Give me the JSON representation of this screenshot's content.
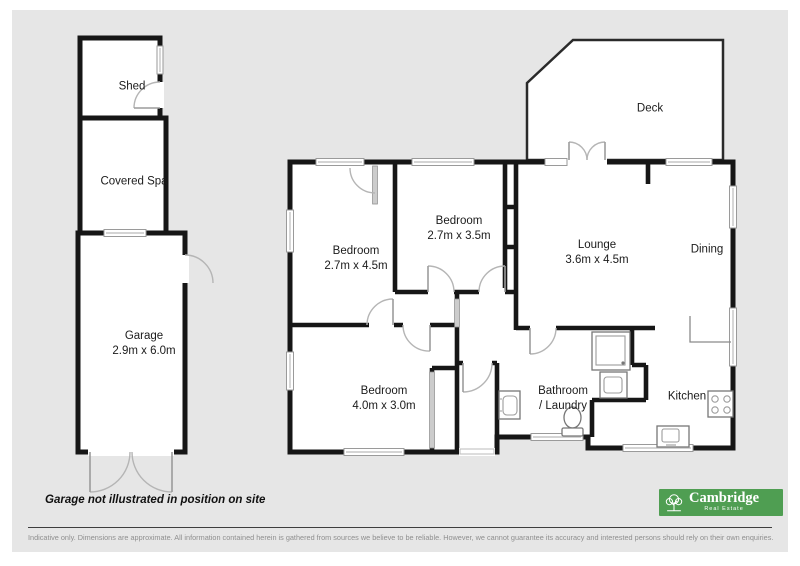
{
  "colors": {
    "background": "#e6e6e6",
    "wall": "#161616",
    "window": "#9a9a9a",
    "door_arc": "#b5b5b5",
    "fixture": "#777777",
    "logo_green": "#4f9e52"
  },
  "plan": {
    "rooms": [
      {
        "id": "shed",
        "name": "Shed",
        "dims": ""
      },
      {
        "id": "covered_spa",
        "name": "Covered Spa",
        "dims": ""
      },
      {
        "id": "garage",
        "name": "Garage",
        "dims": "2.9m x 6.0m"
      },
      {
        "id": "bedroom1",
        "name": "Bedroom",
        "dims": "2.7m x 4.5m"
      },
      {
        "id": "bedroom2",
        "name": "Bedroom",
        "dims": "2.7m x 3.5m"
      },
      {
        "id": "lounge",
        "name": "Lounge",
        "dims": "3.6m x 4.5m"
      },
      {
        "id": "dining",
        "name": "Dining",
        "dims": ""
      },
      {
        "id": "deck",
        "name": "Deck",
        "dims": ""
      },
      {
        "id": "bedroom3",
        "name": "Bedroom",
        "dims": "4.0m x 3.0m"
      },
      {
        "id": "bathroom_laundry",
        "name": "Bathroom",
        "dims": "/ Laundry"
      },
      {
        "id": "kitchen",
        "name": "Kitchen",
        "dims": ""
      }
    ],
    "note": "Garage not illustrated in position on site"
  },
  "footer": {
    "disclaimer": "Indicative only. Dimensions are approximate. All information contained herein is gathered from sources we believe to be reliable. However, we cannot guarantee its accuracy and interested persons should rely on their own enquiries."
  },
  "logo": {
    "name": "Cambridge",
    "tagline": "Real Estate"
  }
}
